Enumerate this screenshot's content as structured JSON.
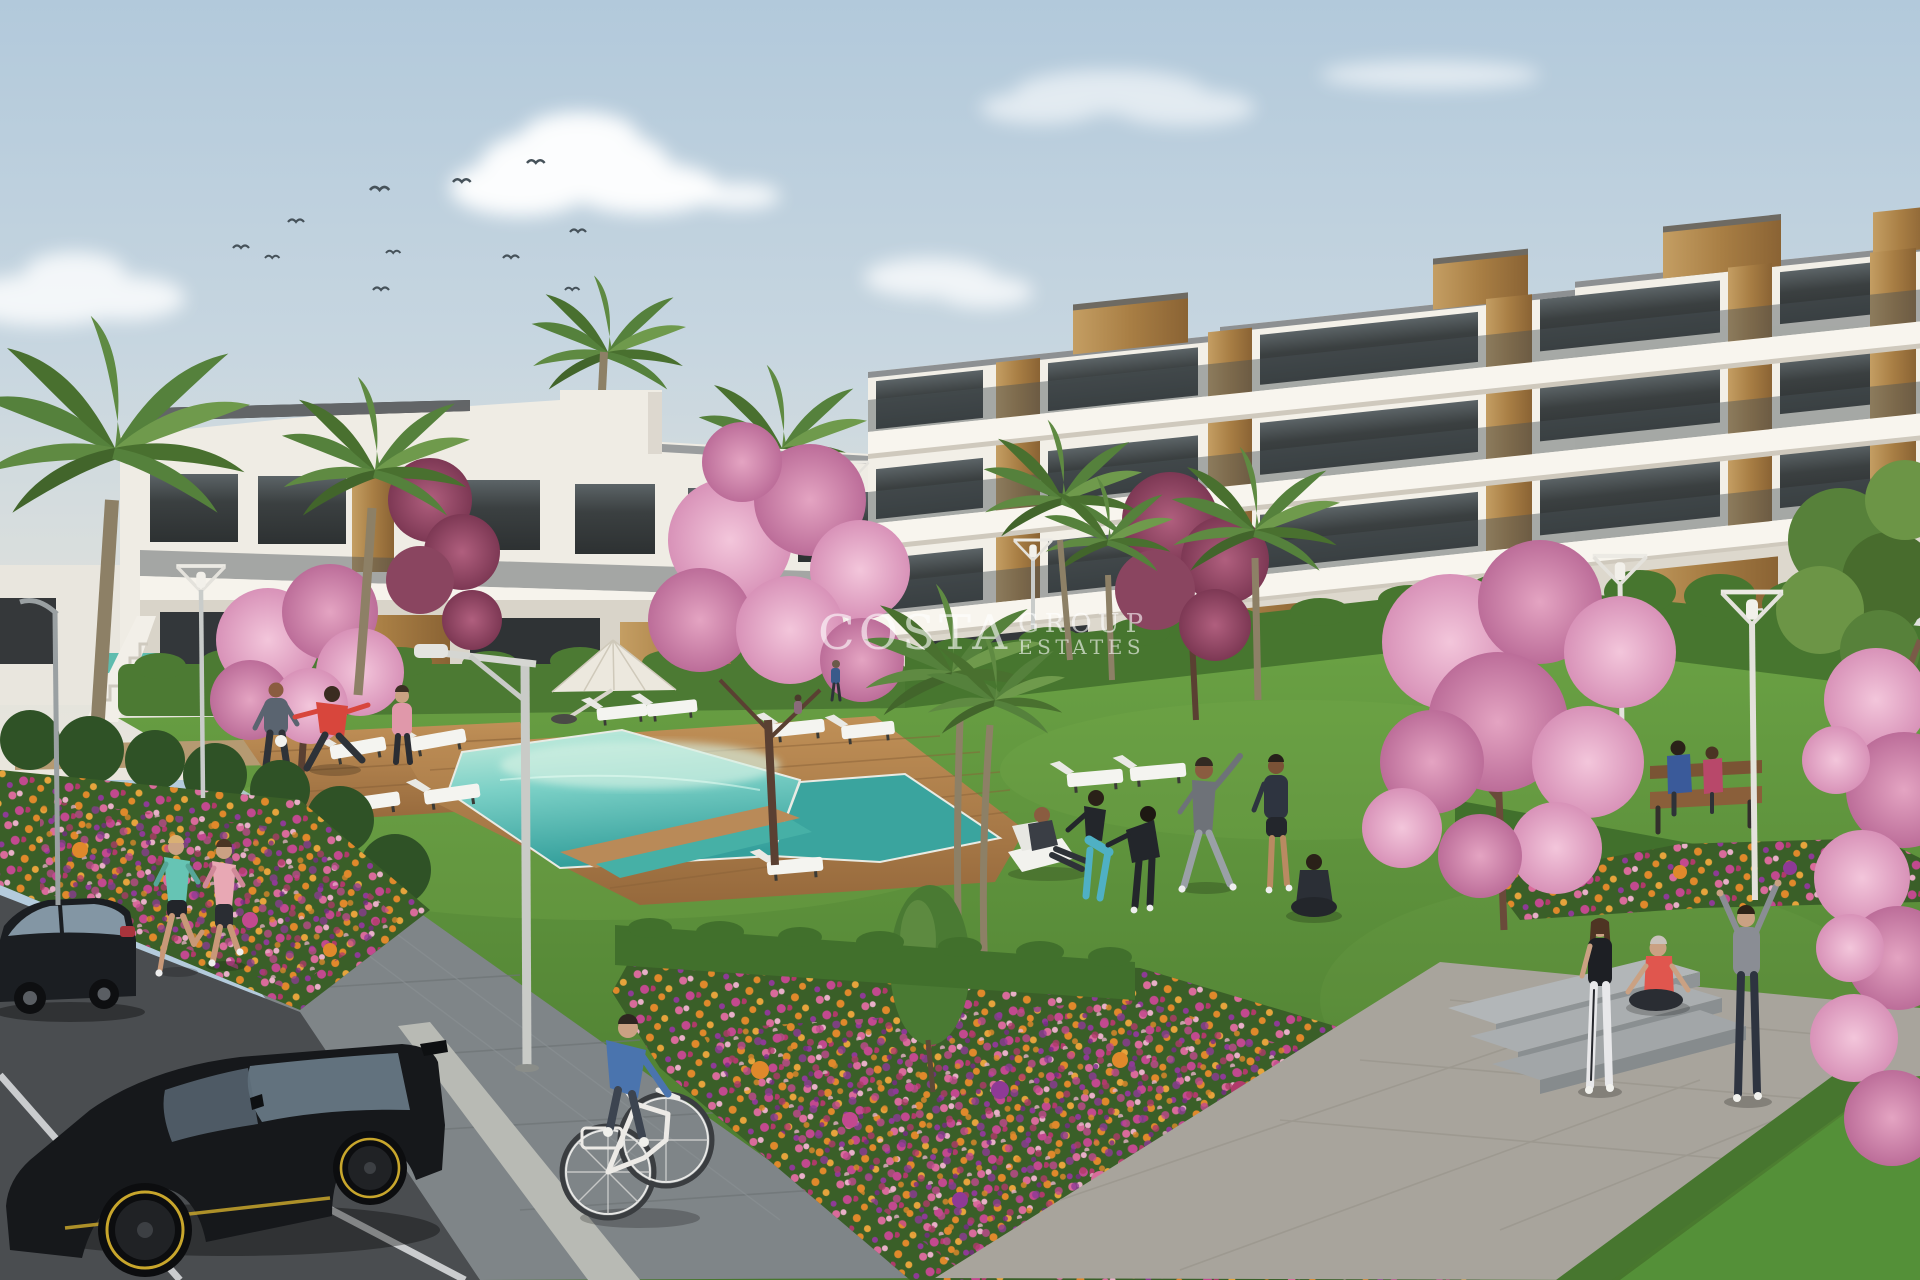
{
  "watermark": {
    "primary": "COSTA",
    "secondary": "GROUP",
    "tertiary": "ESTATES"
  },
  "scene": {
    "setting": "Sunny architectural render of a modern white apartment complex with communal lawn, swimming pool, flower beds and street parking",
    "sky": {
      "bird_count": 11,
      "cloud_count": 6
    },
    "buildings": [
      {
        "name": "three-storey apartment block",
        "position": "right",
        "features": [
          "white balconies",
          "tinted glass balustrades",
          "timber cladding panels",
          "rooftop timber volumes"
        ]
      },
      {
        "name": "two-storey apartment wing",
        "position": "left-centre",
        "features": [
          "flat roof",
          "recessed glazing",
          "timber cladding",
          "external staircase"
        ]
      }
    ],
    "amenities": [
      "communal swimming pool",
      "timber pool deck",
      "white parasol",
      "sun loungers",
      "park benches",
      "concrete garden steps",
      "street lamps"
    ],
    "vegetation": [
      "palm trees",
      "pink cherry-blossom trees",
      "clipped hedges",
      "orange pink and purple flower beds",
      "lawn"
    ],
    "vehicles": [
      "black sedan",
      "black hatchback with yellow rims",
      "white city bicycle"
    ],
    "people": [
      "two joggers on the footpath",
      "man juggling a football",
      "man stretching in a red shirt",
      "woman in pink sportswear",
      "man reading on a deckchair",
      "woman squatting in teal leggings",
      "person exercising in black tracksuit",
      "man stretching arms overhead",
      "man in dark shorts",
      "person meditating cross-legged",
      "couple seated on a bench",
      "three girls beside the steps",
      "cyclist in a blue sweater"
    ]
  },
  "palette": {
    "sky_top": "#b4cbdc",
    "sky_horizon": "#eae6dd",
    "cloud": "#ffffff",
    "building_white": "#f2efe7",
    "building_shadow": "#d8d3c9",
    "wood_accent": "#b98c52",
    "glass_dark": "#3b3e3e",
    "balustrade_grey": "#4a5357",
    "hedge_green": "#47762f",
    "lawn_light": "#71a747",
    "lawn_dark": "#4c7c30",
    "pool_light": "#c6ecdf",
    "pool_deep": "#3aa49e",
    "deck_wood": "#b5885c",
    "blossom_pink": "#e7a9c6",
    "blossom_deep": "#c1719d",
    "flower_orange": "#e0892b",
    "flower_magenta": "#c2498f",
    "flower_purple": "#8e3a96",
    "path_grey": "#7f8588",
    "plaza_grey": "#a8a49c",
    "asphalt": "#4a4d50",
    "car_black": "#16181b",
    "rim_yellow": "#c8a62c",
    "watermark_white": "#ffffff"
  }
}
